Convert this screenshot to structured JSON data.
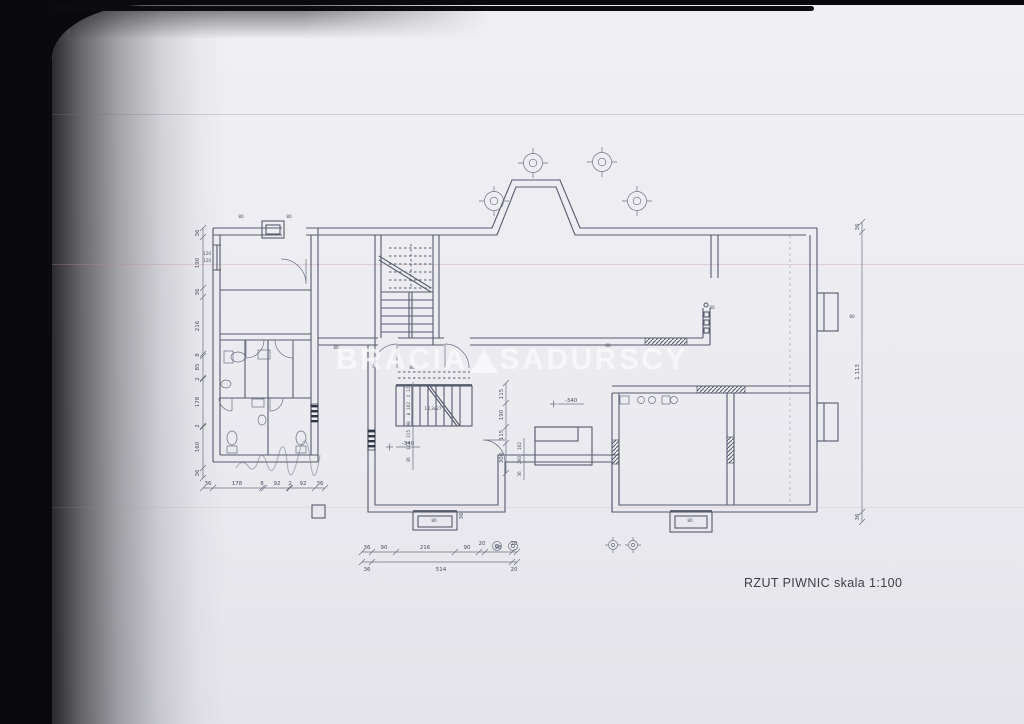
{
  "scan": {
    "caption": "RZUT PIWNIC skala 1:100",
    "watermark_left": "BRACIA",
    "watermark_right": "SADURSCY"
  },
  "labels": {
    "level_mark": "-340",
    "stair_note": "18,3x27",
    "vent": "80",
    "window_top": "120",
    "window_bottom": "120"
  },
  "dims": {
    "left": [
      "36",
      "190",
      "36",
      "216",
      "8",
      "85",
      "2",
      "178",
      "2",
      "160",
      "36"
    ],
    "bottom_left": [
      "36",
      "178",
      "8",
      "92",
      "2",
      "92",
      "36"
    ],
    "bottom_center_top": [
      "36",
      "90",
      "216",
      "90",
      "20",
      "98",
      "20"
    ],
    "bottom_center_bottom": [
      "36",
      "514",
      "20"
    ],
    "right": [
      "36",
      "1 113",
      "36"
    ],
    "inner_vertical": [
      "115",
      "190",
      "115",
      "300",
      "36"
    ],
    "corridor": [
      "120",
      "2",
      "102",
      "8",
      "98",
      "115",
      "123",
      "36"
    ],
    "corridor2": [
      "102",
      "260",
      "36"
    ]
  }
}
